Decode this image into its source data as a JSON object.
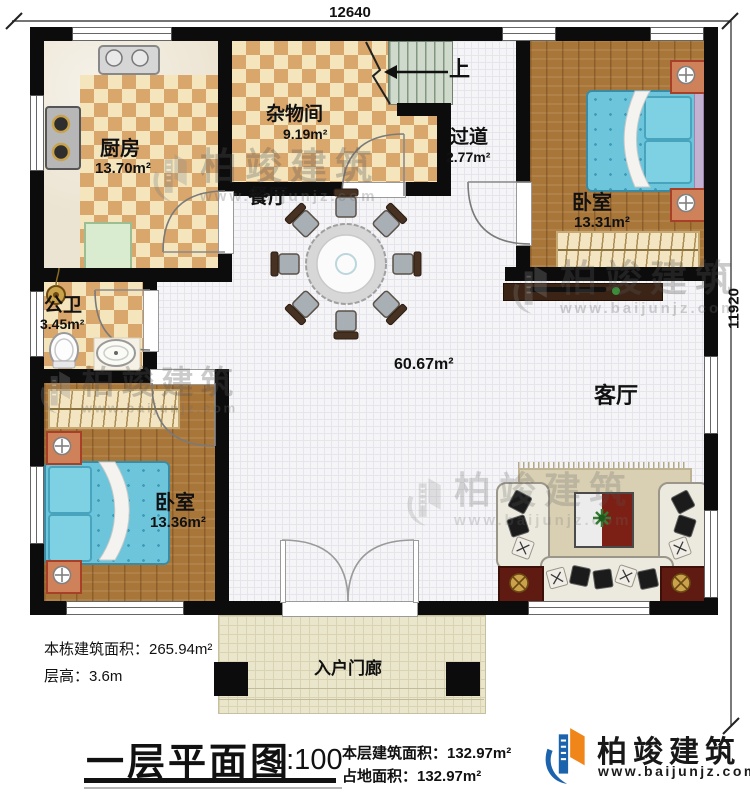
{
  "dimensions": {
    "top": "12640",
    "right": "11920"
  },
  "rooms": {
    "kitchen": {
      "name": "厨房",
      "area": "13.70m²"
    },
    "storage": {
      "name": "杂物间",
      "area": "9.19m²"
    },
    "hallway": {
      "name": "过道",
      "area": "2.77m²"
    },
    "bedroom1": {
      "name": "卧室",
      "area": "13.31m²"
    },
    "dining": {
      "name": "餐厅"
    },
    "bathroom": {
      "name": "公卫",
      "area": "3.45m²"
    },
    "bedroom2": {
      "name": "卧室",
      "area": "13.36m²"
    },
    "living": {
      "name": "客厅",
      "area_label": "60.67m²"
    },
    "porch": {
      "name": "入户门廊"
    }
  },
  "stairs": {
    "up_label": "上"
  },
  "notes": {
    "building_area": "本栋建筑面积：265.94m²",
    "floor_height": "层高：3.6m"
  },
  "title_block": {
    "title": "一层平面图",
    "scale": "1:100",
    "floor_area": "本层建筑面积：132.97m²",
    "footprint_area": "占地面积：132.97m²"
  },
  "brand": {
    "name": "柏竣建筑",
    "website": "www.baijunjz.com"
  },
  "watermark": {
    "name": "柏竣建筑",
    "website": "www.baijunjz.com"
  },
  "colors": {
    "wall": "#0c0c0c",
    "brand_blue": "#1c63ad",
    "brand_orange": "#f08519",
    "bed_blue": "#6cc5db",
    "checker_tan": "#d9a76c"
  }
}
